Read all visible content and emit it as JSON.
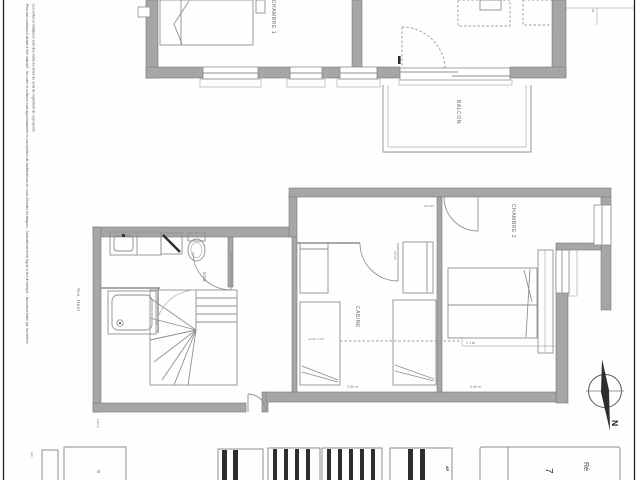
{
  "document": {
    "type": "architectural-floor-plan",
    "orientation": "rotated-90-clockwise"
  },
  "colors": {
    "paper": "#fefefe",
    "wall_gray": "#a6a6a6",
    "line_gray": "#8f8f8f",
    "ink_dark": "#2e2e2e"
  },
  "plan_upper": {
    "labels": {
      "chambre1": "CHAMBRE 1",
      "balcon": "BALCON"
    },
    "tag": "05"
  },
  "plan_lower": {
    "labels": {
      "chambre2": "CHAMBRE 2",
      "cabine": "CABINE",
      "sdb": "SDB",
      "niv_haut": "Niv. Haut"
    },
    "annotations": {
      "door_tag": "AP 056",
      "cabine_door_tag": "PO 05",
      "bed_note": "couch. 0.90",
      "dim_bed": "0.90 m",
      "dim_right": "0.40 m",
      "h180": "h. 1.80",
      "dim_left": "2,96 m"
    }
  },
  "compass": {
    "north": "N"
  },
  "disclaimer": {
    "line1": "Plan non contractuel donné à titre indicatif - les cotes et surfaces sont approximatives et susceptibles de modifications en cours d'études techniques - l'ameublement est figuré à titre d'exemple - document établi par l'architecte",
    "line2": "Les surfaces indiquées sont des surfaces utiles au sens du règlement de copropriété"
  },
  "titleblock": {
    "scale_label": "Ech.",
    "sheet_tag": "S",
    "ap_tag": "AP",
    "number": "7",
    "title_prefix": "Ré"
  }
}
